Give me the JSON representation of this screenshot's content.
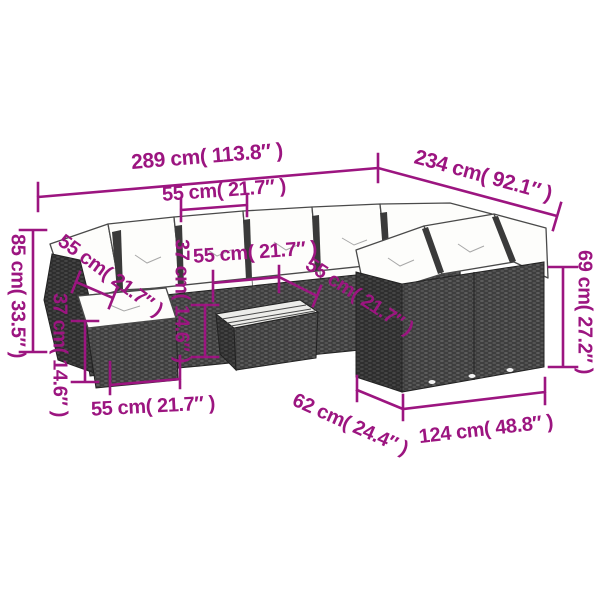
{
  "accent_color": "#9c1580",
  "dims": {
    "total_width": "289 cm( 113.8″ )",
    "total_depth": "234 cm( 92.1″ )",
    "seat_top": "55 cm( 21.7″ )",
    "overall_height": "85 cm( 33.5″ )",
    "back_left": "55 cm( 21.7″ )",
    "ottoman_height": "37 cm( 14.6″ )",
    "seat_mid": "55 cm( 21.7″ )",
    "table_height": "37 cm( 14.6″ )",
    "seat_right": "55 cm( 21.7″ )",
    "arm_height": "69 cm( 27.2″ )",
    "ottoman_width": "55 cm( 21.7″ )",
    "module_depth": "62 cm( 24.4″ )",
    "module_width": "124 cm( 48.8″ )"
  }
}
